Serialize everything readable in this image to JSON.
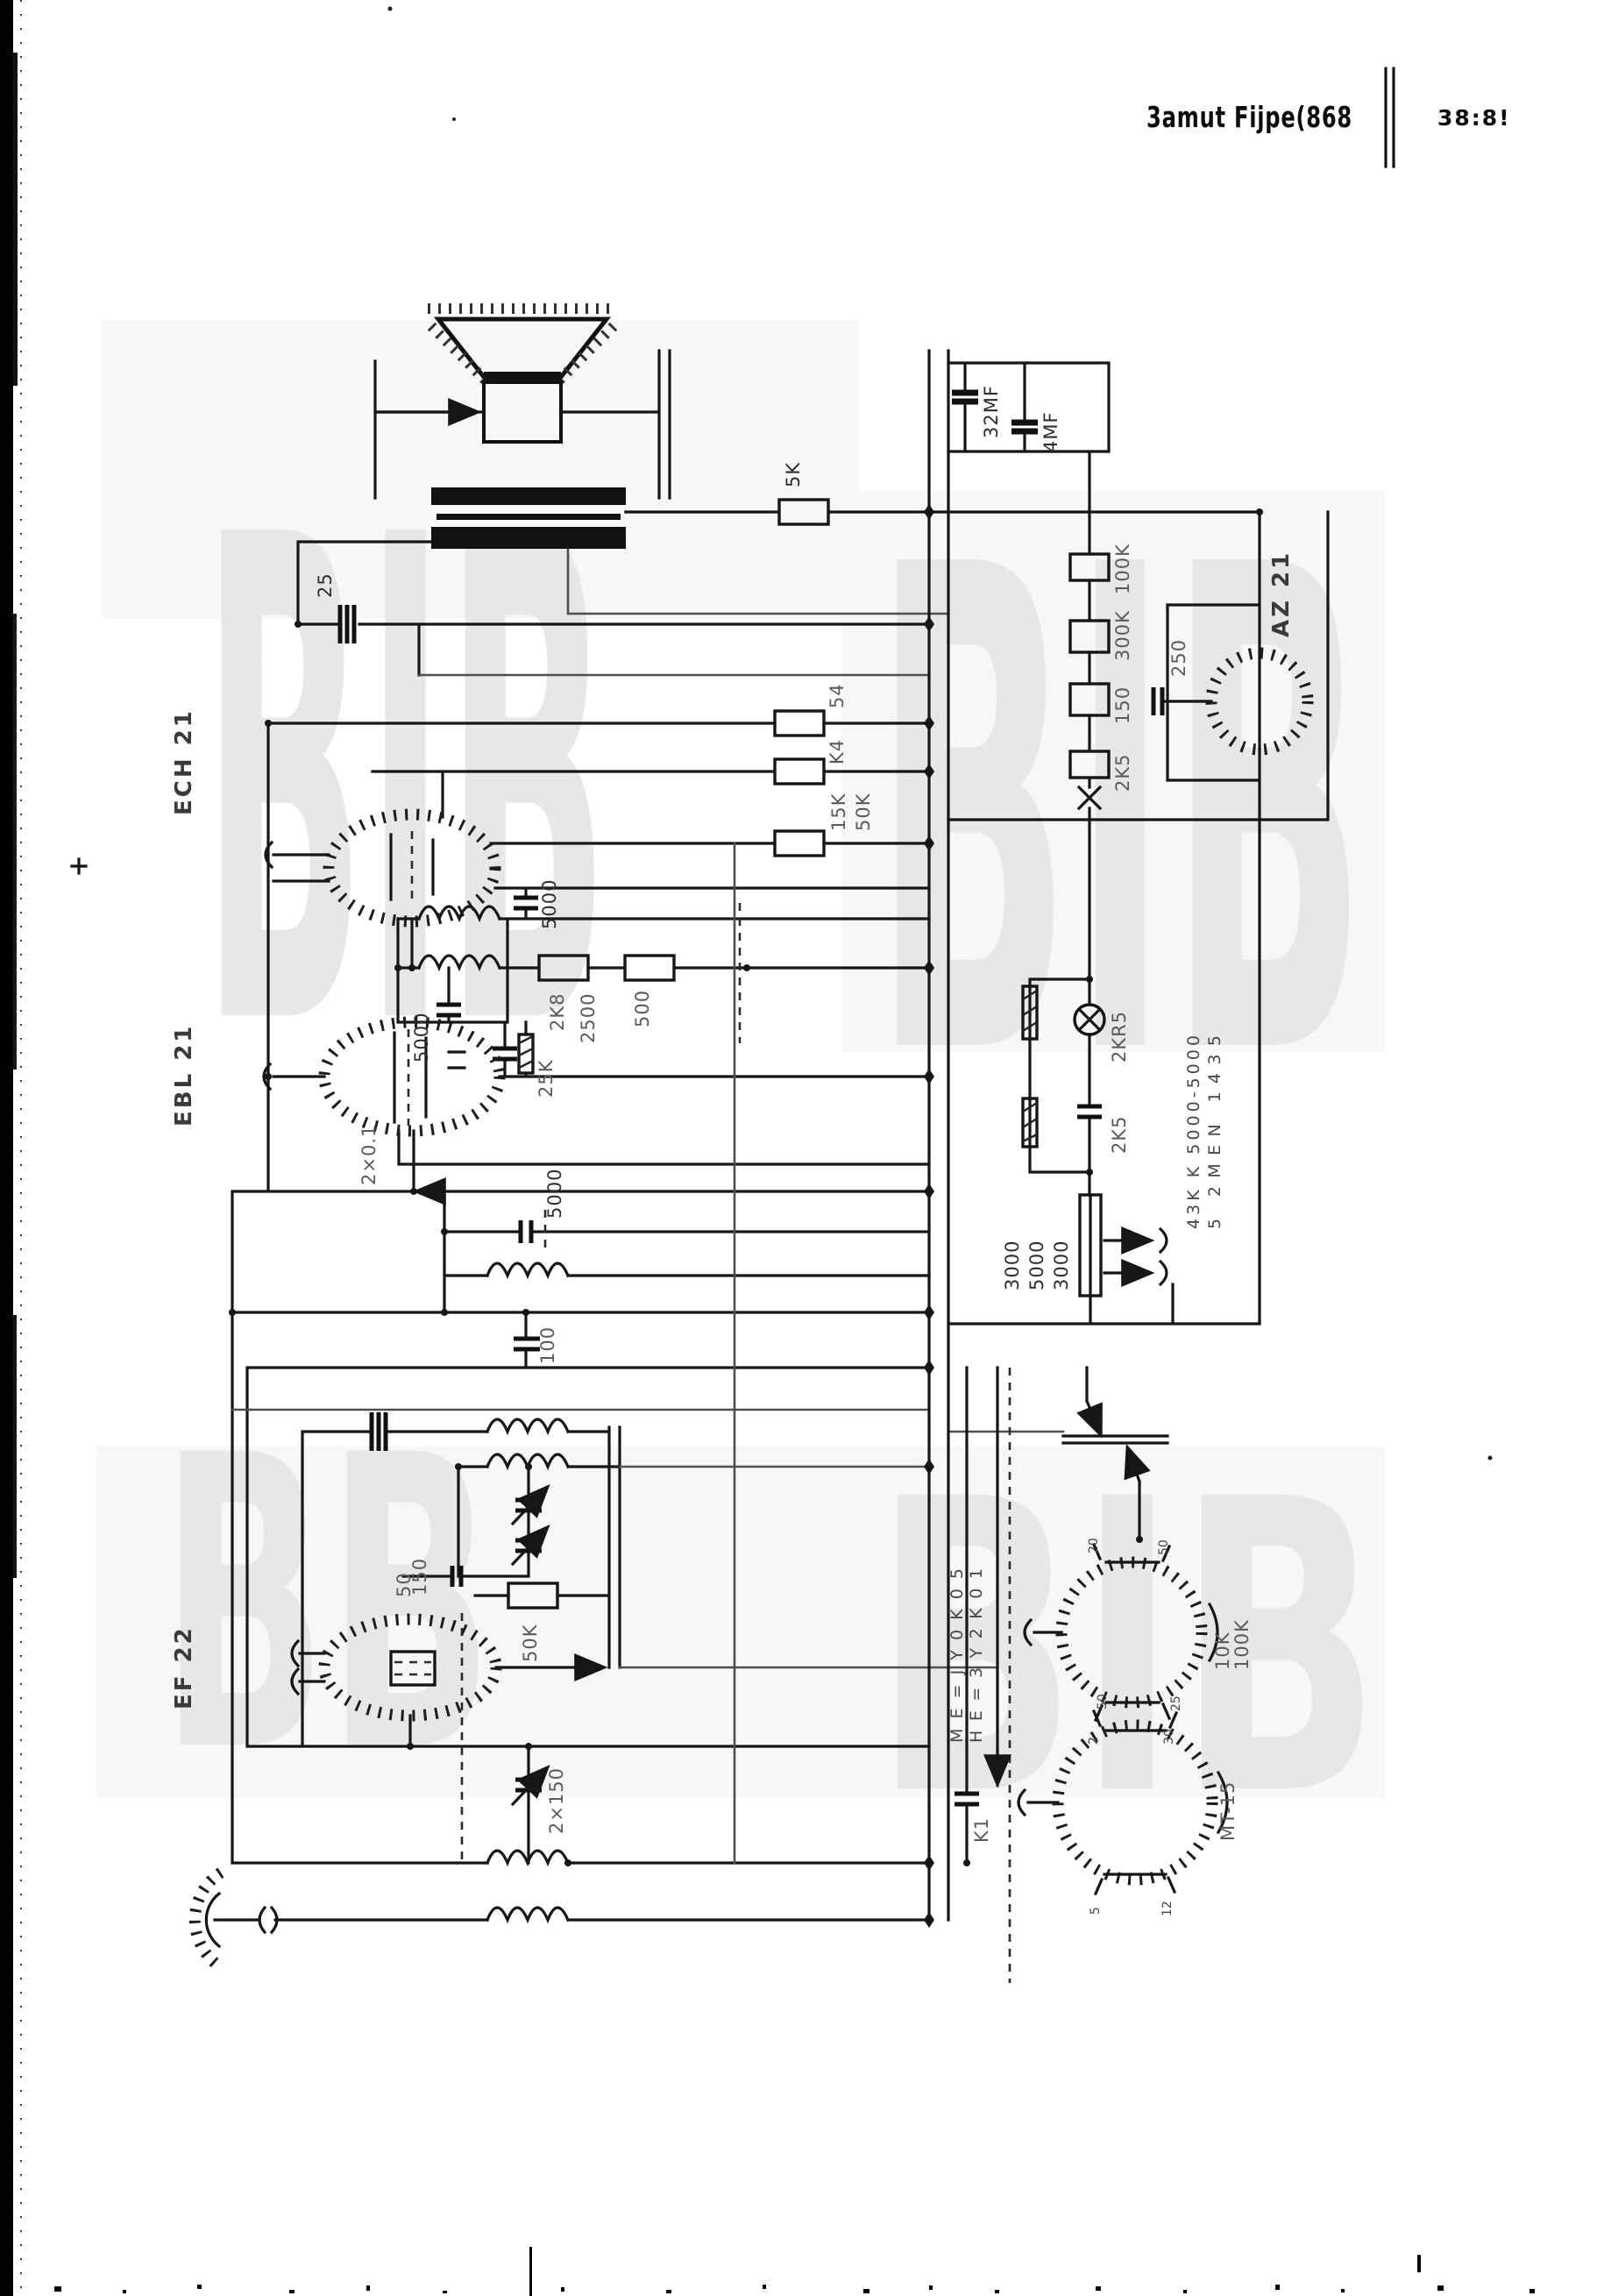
{
  "header": {
    "title": "3amut Fijpe(868",
    "page_number": "38:8!"
  },
  "watermarks": {
    "w1": "BIB",
    "w2": "BIB",
    "w3": "BB",
    "w4": "BIB"
  },
  "tubes": {
    "tube1": "ECH 21",
    "tube2": "EBL 21",
    "tube3": "EF 22",
    "rectifier": "AZ 21"
  },
  "values": {
    "out_res": "5K",
    "trim_top": "25",
    "r54": "54",
    "rk4": "K4",
    "r15k": "15K",
    "r50k": "50K",
    "c5000a": "5000",
    "c2500": "2500",
    "c5000b": "5000",
    "r2k8": "2K8",
    "r500": "500",
    "r25k": "25K",
    "t2_cath": "2×0.1",
    "c5000c": "5000",
    "c100": "100",
    "c150a": "150",
    "c50": "50",
    "r50kb": "50K",
    "c2x150": "2×150",
    "ec1": "32MF",
    "ec2": "4MF",
    "chain1": "100K",
    "chain2": "300K",
    "chain3": "150",
    "chain4": "2K5",
    "lamp": "2KR5",
    "cap_2k5": "2K5",
    "div1": "3000",
    "div2": "5000",
    "div3": "3000",
    "rect_cap": "250",
    "k1": "K1"
  },
  "sockets": {
    "a_side1": "10K",
    "a_side2": "100K",
    "b_side": "MT-15",
    "a_p1": "20",
    "a_p2": "50",
    "a_p3": "2",
    "a_p4": "30",
    "b_p1": "50",
    "b_p2": "25",
    "b_p3": "5",
    "b_p4": "12"
  },
  "legends": {
    "left1": "ME=JY0K05",
    "left2": "HE=3Y2K01",
    "right1": "43K K 5000-5000",
    "right2": "5 2MEN 1435"
  },
  "colors": {
    "ink": "#161616",
    "gray_ink": "#4f4f4f",
    "watermark": "#e7e7e7",
    "paper": "#ffffff"
  }
}
